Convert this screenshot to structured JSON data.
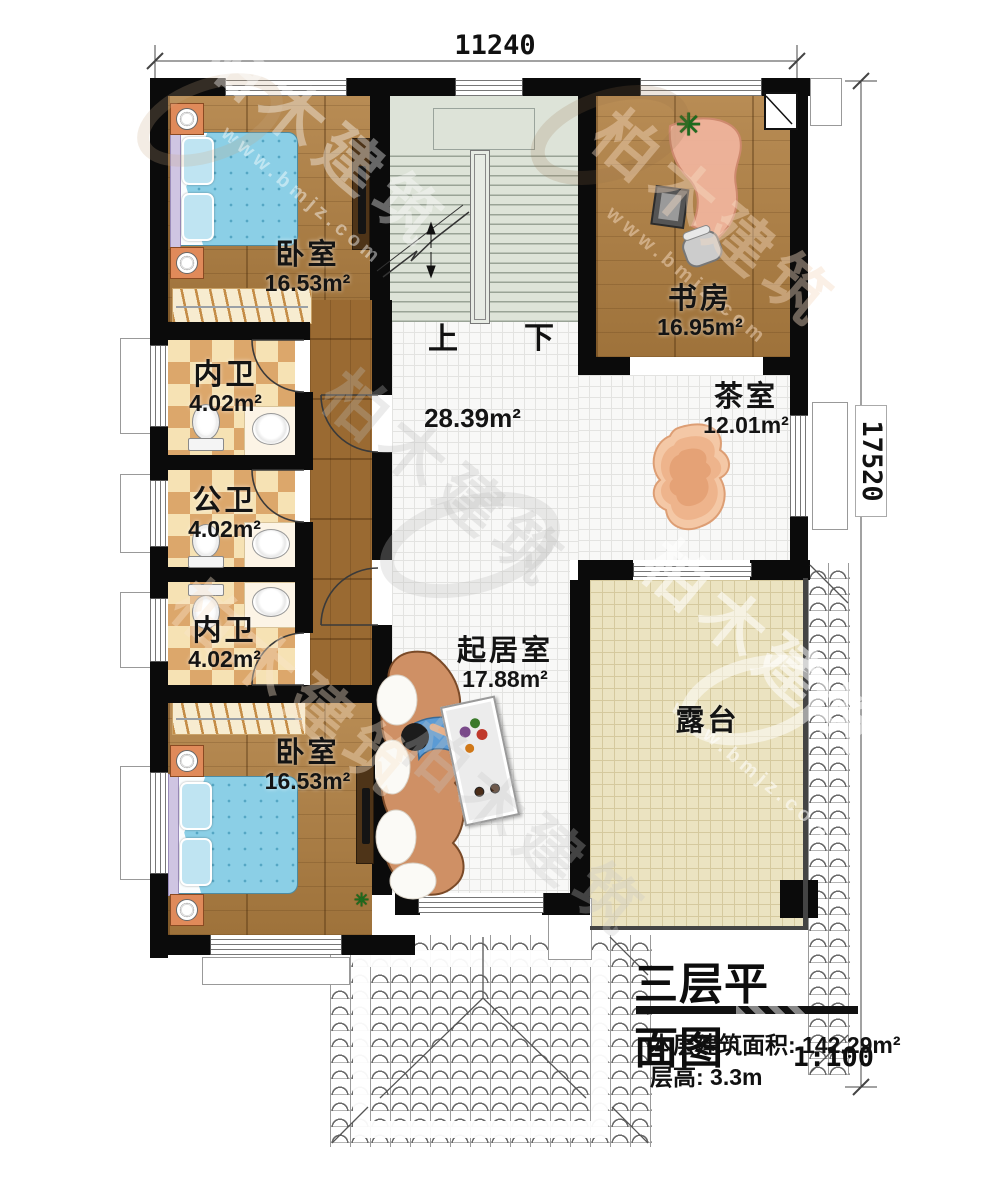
{
  "watermark": {
    "brand": "柏木建筑",
    "url": "www.bmjz.com"
  },
  "dimensions": {
    "top": "11240",
    "right": "17520"
  },
  "stairs": {
    "up": "上",
    "down": "下"
  },
  "rooms": {
    "bedroom_top": {
      "name": "卧室",
      "area": "16.53m²"
    },
    "study": {
      "name": "书房",
      "area": "16.95m²"
    },
    "bath_top": {
      "name": "内卫",
      "area": "4.02m²"
    },
    "bath_mid": {
      "name": "公卫",
      "area": "4.02m²"
    },
    "bath_bottom": {
      "name": "内卫",
      "area": "4.02m²"
    },
    "hall": {
      "area": "28.39m²"
    },
    "tea_room": {
      "name": "茶室",
      "area": "12.01m²"
    },
    "living_room": {
      "name": "起居室",
      "area": "17.88m²"
    },
    "terrace": {
      "name": "露台"
    },
    "bedroom_bottom": {
      "name": "卧室",
      "area": "16.53m²"
    }
  },
  "title_block": {
    "title": "三层平面图",
    "scale": "1:100",
    "area_line": "本层建筑面积: 142.29m²",
    "height_line": "层高: 3.3m"
  }
}
